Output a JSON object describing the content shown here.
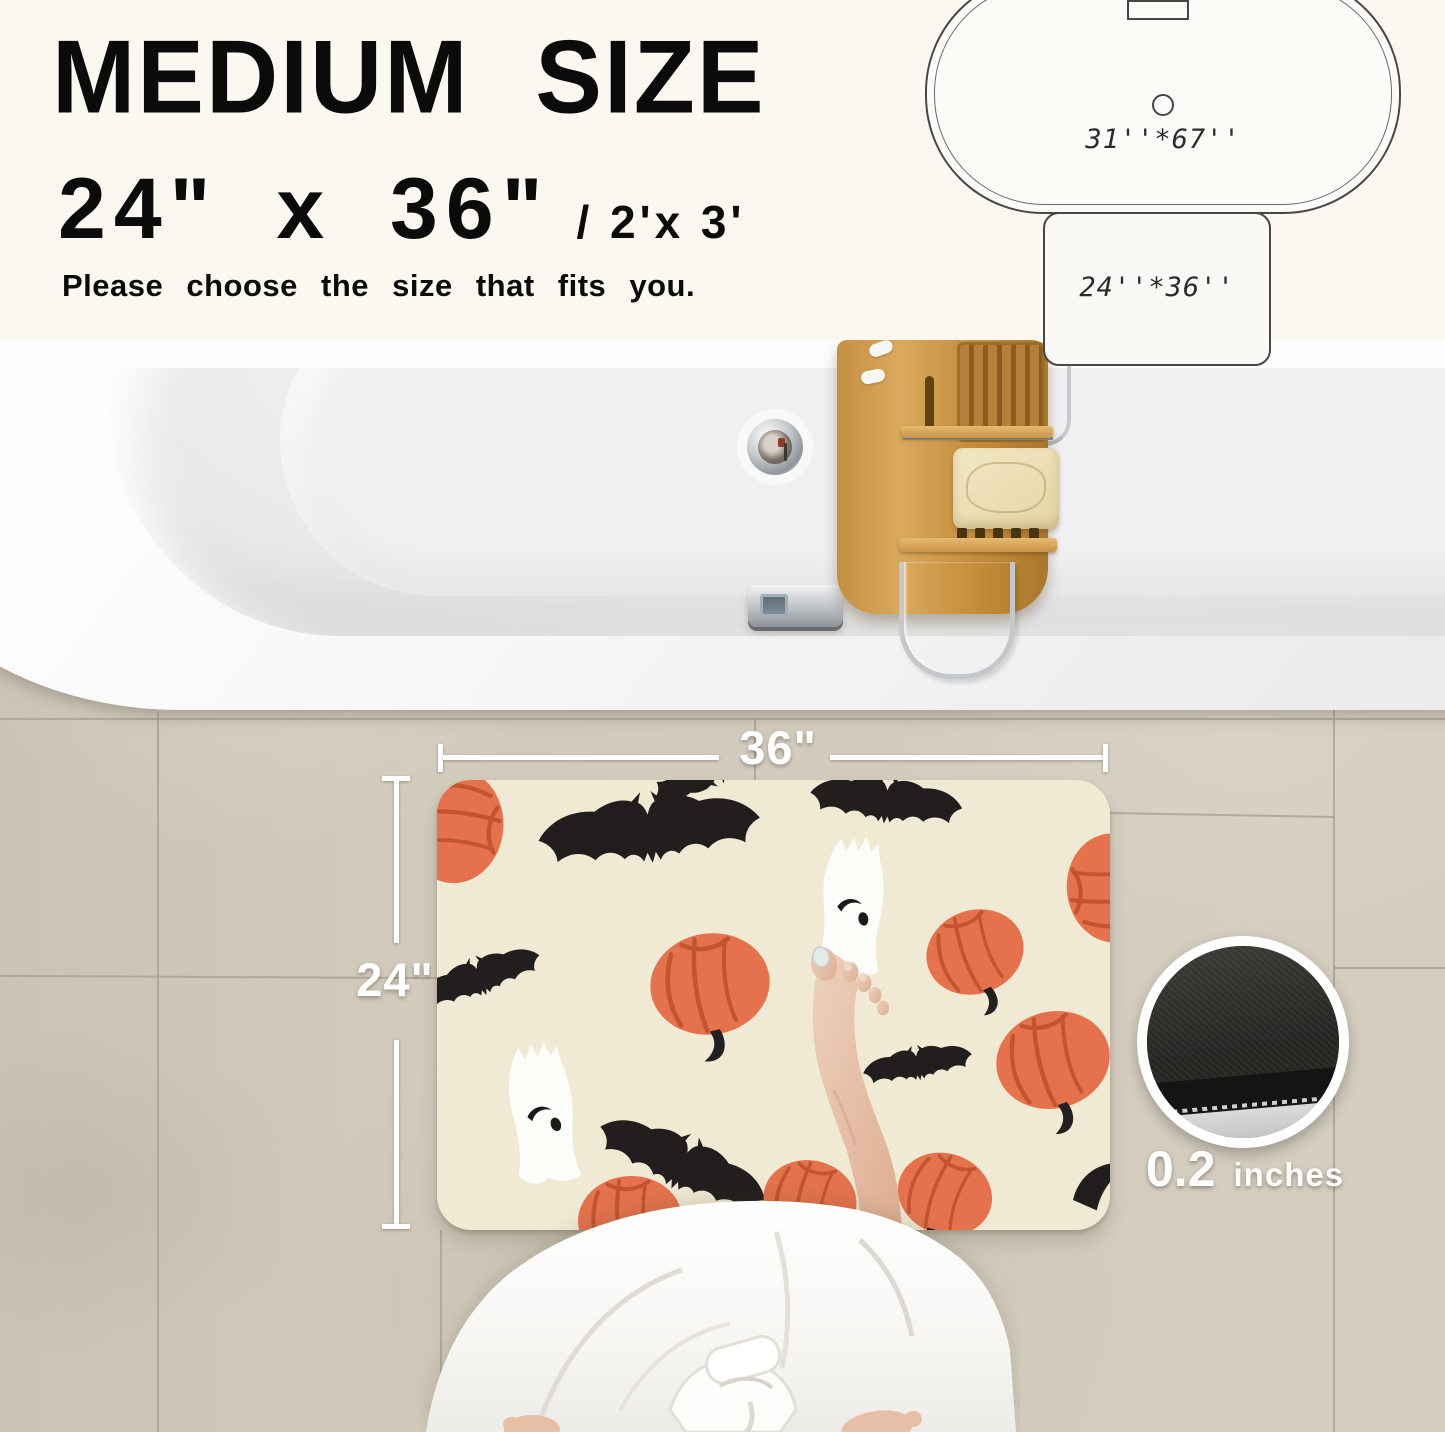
{
  "header": {
    "title": "MEDIUM SIZE",
    "size_primary": "24\" x 36\"",
    "size_secondary": "/ 2'x 3'",
    "subtitle": "Please choose the size that fits you."
  },
  "size_comparison": {
    "bathtub_label": "31''*67''",
    "mat_label": "24''*36''"
  },
  "scene": {
    "mat_width_label": "36\"",
    "mat_height_label": "24\"",
    "thickness_value": "0.2",
    "thickness_unit": "inches",
    "mat_pattern_motifs": [
      "pumpkin",
      "bat",
      "ghost"
    ],
    "colors": {
      "mat_background": "#f0ead4",
      "pumpkin": "#e5724d",
      "bat": "#211e1d",
      "ghost": "#fcfcf9",
      "floor_tile": "#d2cbbc",
      "bathtub": "#fbfbfb",
      "caddy_wood": "#c8913f"
    }
  }
}
